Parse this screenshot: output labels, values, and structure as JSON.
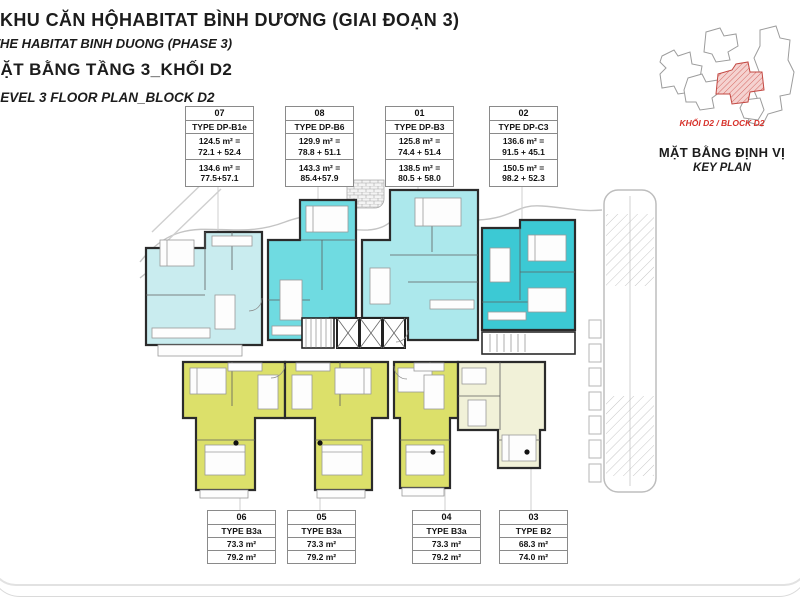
{
  "title_block": {
    "project_vi": "KHU CĂN HỘHABITAT BÌNH DƯƠNG (GIAI ĐOẠN 3)",
    "project_en": "THE HABITAT BINH DUONG (PHASE 3)",
    "plan_vi": "MẶT BẰNG TẦNG 3_KHỐI D2",
    "plan_en": "LEVEL 3 FLOOR PLAN_BLOCK D2"
  },
  "key_plan": {
    "block_label": "KHỐI D2 / BLOCK D2",
    "title_vi": "MẶT BẰNG ĐỊNH VỊ",
    "title_en": "KEY PLAN"
  },
  "top_units": [
    {
      "number": "07",
      "type": "TYPE DP-B1e",
      "area_a": "124.5 m² =",
      "area_a2": "72.1 + 52.4",
      "area_b": "134.6 m² =",
      "area_b2": "77.5+57.1"
    },
    {
      "number": "08",
      "type": "TYPE DP-B6",
      "area_a": "129.9 m² =",
      "area_a2": "78.8 + 51.1",
      "area_b": "143.3 m² =",
      "area_b2": "85.4+57.9"
    },
    {
      "number": "01",
      "type": "TYPE DP-B3",
      "area_a": "125.8 m² =",
      "area_a2": "74.4 + 51.4",
      "area_b": "138.5 m² =",
      "area_b2": "80.5 + 58.0"
    },
    {
      "number": "02",
      "type": "TYPE DP-C3",
      "area_a": "136.6 m² =",
      "area_a2": "91.5 + 45.1",
      "area_b": "150.5 m² =",
      "area_b2": "98.2 + 52.3"
    }
  ],
  "bottom_units": [
    {
      "number": "06",
      "type": "TYPE B3a",
      "area_a": "73.3 m²",
      "area_b": "79.2 m²"
    },
    {
      "number": "05",
      "type": "TYPE B3a",
      "area_a": "73.3 m²",
      "area_b": "79.2 m²"
    },
    {
      "number": "04",
      "type": "TYPE B3a",
      "area_a": "73.3 m²",
      "area_b": "79.2 m²"
    },
    {
      "number": "03",
      "type": "TYPE B2",
      "area_a": "68.3 m²",
      "area_b": "74.0 m²"
    }
  ],
  "colors": {
    "unit_07": "#c9ecef",
    "unit_08": "#6fdbe1",
    "unit_01": "#ace8ec",
    "unit_02": "#3cc9d4",
    "unit_yellow": "#dce06a",
    "unit_03": "#f1f1d8",
    "wall": "#2b2b2b",
    "path_gray": "#c4c4c4",
    "accent_red": "#d7312a",
    "keyplan_pink": "#f5d2d0"
  }
}
